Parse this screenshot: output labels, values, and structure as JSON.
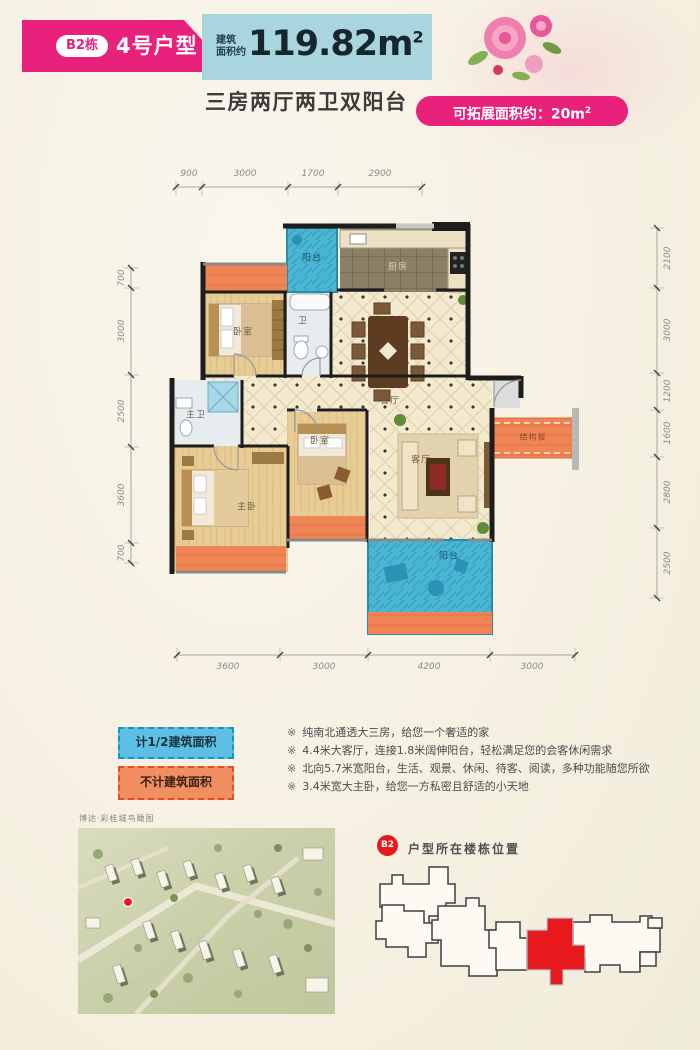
{
  "header": {
    "badge": "B2栋",
    "title": "4号户型",
    "area_prefix_1": "建筑",
    "area_prefix_2": "面积约",
    "area_value": "119.82m",
    "area_sup": "2",
    "subtitle": "三房两厅两卫双阳台",
    "expand_label": "可拓展面积约：20m",
    "expand_sup": "2"
  },
  "floorplan": {
    "dims_top": [
      "900",
      "3000",
      "1700",
      "2900"
    ],
    "dims_bottom": [
      "3600",
      "3000",
      "4200",
      "3000"
    ],
    "dims_left": [
      "700",
      "3000",
      "2500",
      "3600",
      "700"
    ],
    "dims_right": [
      "2100",
      "3000",
      "1200",
      "1600",
      "2800",
      "2500"
    ],
    "rooms": {
      "balcony_top": "阳台",
      "kitchen": "厨房",
      "bath": "卫",
      "bedroom_top": "卧室",
      "dining": "餐厅",
      "master_bath": "主卫",
      "bedroom_mid": "卧室",
      "living": "客厅",
      "master_bedroom": "主卧",
      "balcony_bottom": "阳台",
      "slab": "结构板"
    }
  },
  "legend": {
    "half_area": "计1/2建筑面积",
    "excluded": "不计建筑面积"
  },
  "features": {
    "marker": "※",
    "items": [
      "纯南北通透大三房，给您一个奢适的家",
      "4.4米大客厅，连接1.8米阔伸阳台，轻松满足您的会客休闲需求",
      "北向5.7米宽阳台，生活、观景、休闲、待客、阅读，多种功能随您所欲",
      "3.4米宽大主卧，给您一方私密且舒适的小天地"
    ]
  },
  "sitemap": {
    "caption": "博达·彩桂城鸟瞰图"
  },
  "location": {
    "badge": "B2",
    "label": "户型所在楼栋位置"
  },
  "colors": {
    "accent_pink": "#e7217c",
    "banner_teal": "#a9d6de",
    "balcony_teal": "#49b6d3",
    "excluded_orange": "#ef8455",
    "highlight_red": "#e8191c"
  }
}
